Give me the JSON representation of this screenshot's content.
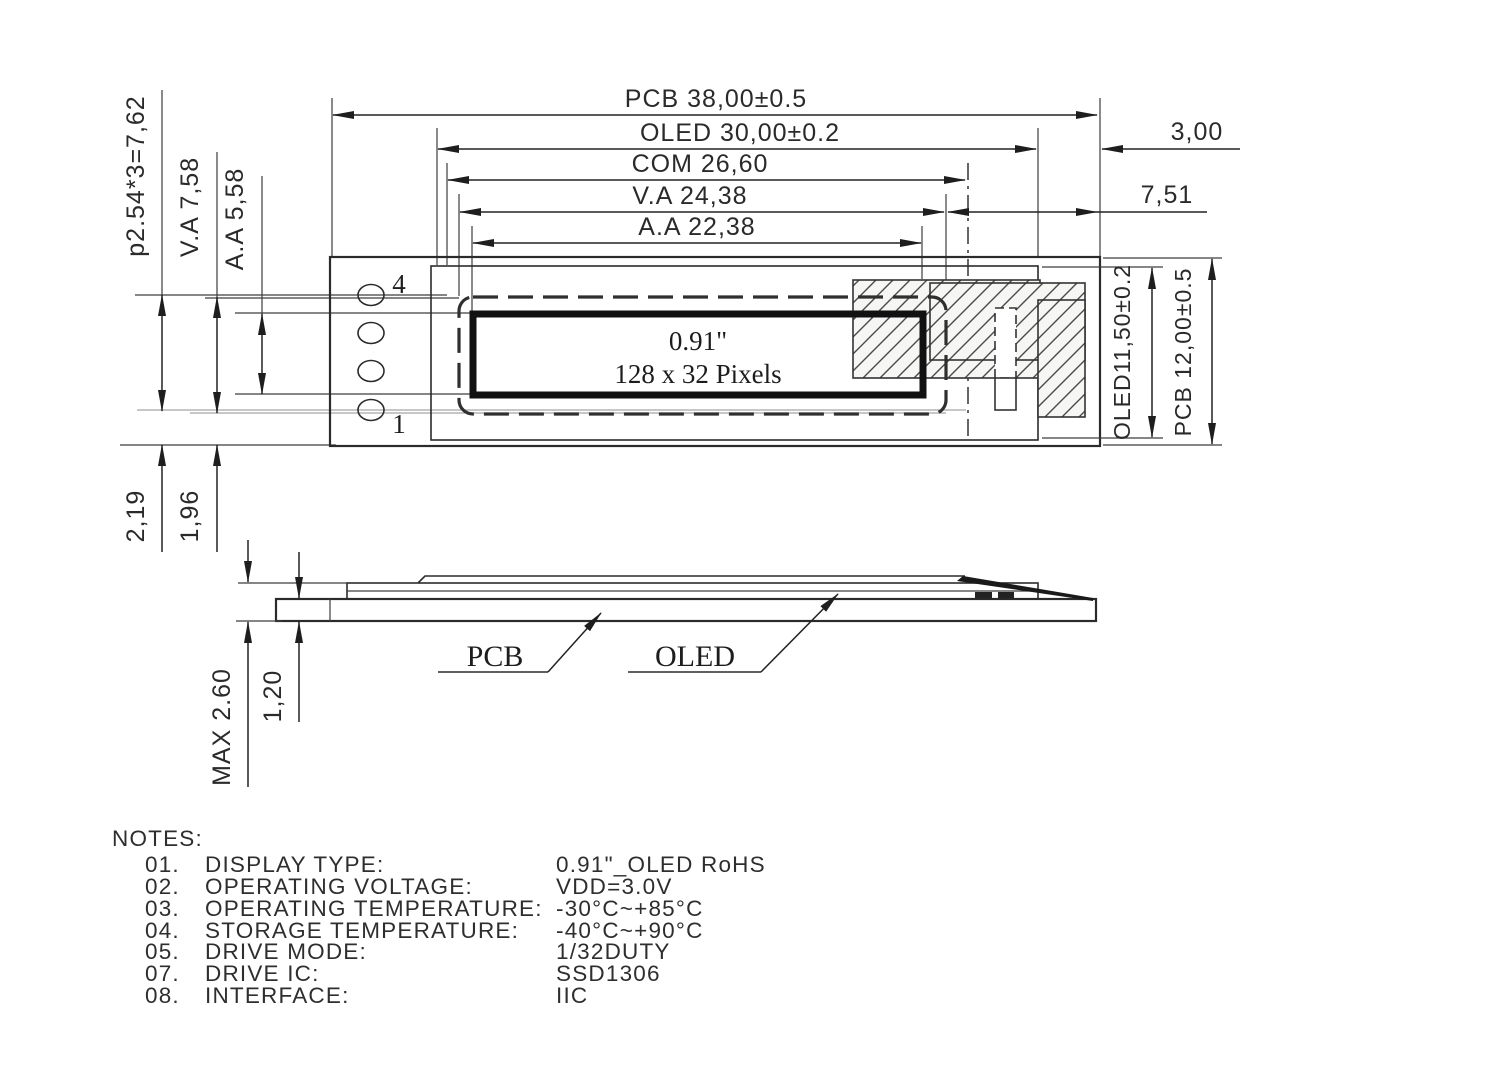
{
  "dims": {
    "pcb_width": "PCB 38,00±0.5",
    "oled_width": "OLED 30,00±0.2",
    "com_width": "COM 26,60",
    "va_width": "V.A 24,38",
    "aa_width": "A.A 22,38",
    "edge_gap": "3,00",
    "right_gap": "7,51",
    "pin_pitch": "p2.54*3=7,62",
    "va_height": "V.A 7,58",
    "aa_height": "A.A 5,58",
    "pin_offset_a": "2,19",
    "pin_offset_b": "1,96",
    "oled_height": "OLED11,50±0.2",
    "pcb_height": "PCB 12,00±0.5",
    "max_thickness": "MAX 2.60",
    "pcb_thickness": "1,20"
  },
  "front": {
    "pin_top": "4",
    "pin_bottom": "1",
    "display_size": "0.91\"",
    "display_pixels": "128 x 32 Pixels"
  },
  "side": {
    "pcb": "PCB",
    "oled": "OLED"
  },
  "notes": {
    "heading": "NOTES:",
    "items": [
      {
        "no": "01.",
        "label": "DISPLAY  TYPE:",
        "value": "0.91\"_OLED RoHS"
      },
      {
        "no": "02.",
        "label": "OPERATING  VOLTAGE:",
        "value": "VDD=3.0V"
      },
      {
        "no": "03.",
        "label": "OPERATING  TEMPERATURE:",
        "value": "-30°C~+85°C"
      },
      {
        "no": "04.",
        "label": "STORAGE  TEMPERATURE:",
        "value": "-40°C~+90°C"
      },
      {
        "no": "05.",
        "label": "DRIVE  MODE:",
        "value": "1/32DUTY"
      },
      {
        "no": "07.",
        "label": "DRIVE  IC:",
        "value": "SSD1306"
      },
      {
        "no": "08.",
        "label": "INTERFACE:",
        "value": "IIC"
      }
    ]
  }
}
